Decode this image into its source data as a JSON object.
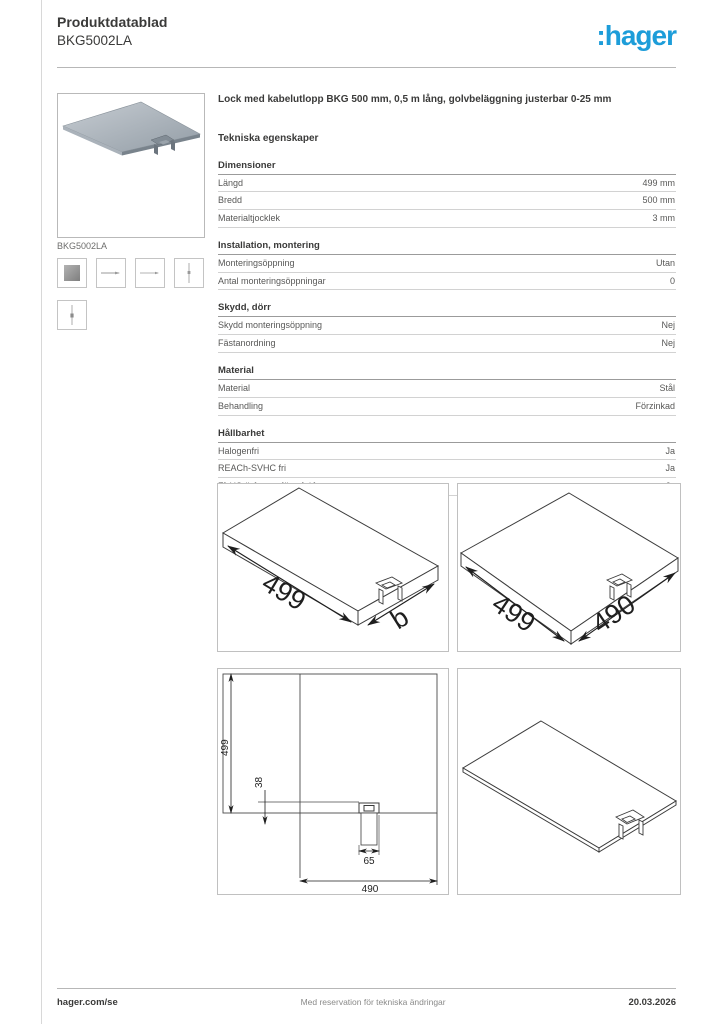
{
  "header": {
    "doc_type": "Produktdatablad",
    "product_id": "BKG5002LA",
    "brand_logo": ":hager",
    "brand_color": "#1d9dd9"
  },
  "product": {
    "image_caption": "BKG5002LA",
    "thumbnails": [
      "product-photo-thumb",
      "side-view-thumb",
      "side-view-thumb-2",
      "end-view-thumb",
      "end-view-thumb-2"
    ]
  },
  "description": "Lock med kabelutlopp BKG 500 mm,  0,5 m lång, golvbeläggning justerbar 0-25 mm",
  "specs": {
    "title": "Tekniska egenskaper",
    "groups": [
      {
        "name": "Dimensioner",
        "rows": [
          {
            "label": "Längd",
            "value": "499 mm"
          },
          {
            "label": "Bredd",
            "value": "500 mm"
          },
          {
            "label": "Materialtjocklek",
            "value": "3 mm"
          }
        ]
      },
      {
        "name": "Installation, montering",
        "rows": [
          {
            "label": "Monteringsöppning",
            "value": "Utan"
          },
          {
            "label": "Antal monteringsöppningar",
            "value": "0"
          }
        ]
      },
      {
        "name": "Skydd, dörr",
        "rows": [
          {
            "label": "Skydd monteringsöppning",
            "value": "Nej"
          },
          {
            "label": "Fästanordning",
            "value": "Nej"
          }
        ]
      },
      {
        "name": "Material",
        "rows": [
          {
            "label": "Material",
            "value": "Stål"
          },
          {
            "label": "Behandling",
            "value": "Förzinkad"
          }
        ]
      },
      {
        "name": "Hållbarhet",
        "rows": [
          {
            "label": "Halogenfri",
            "value": "Ja"
          },
          {
            "label": "REACh-SVHC fri",
            "value": "Ja"
          },
          {
            "label": "RoHS-överensstämmelse",
            "value": "Ja"
          }
        ]
      }
    ]
  },
  "illustrations": {
    "title": "Illustrationer | teckningar",
    "iso1": {
      "dim_long": "499",
      "dim_short": "b"
    },
    "iso2": {
      "dim_long": "499",
      "dim_short": "490"
    },
    "plan": {
      "dim_height": "499",
      "dim_offset": "38",
      "dim_outlet": "65",
      "dim_width": "490"
    }
  },
  "footer": {
    "website": "hager.com/se",
    "disclaimer": "Med reservation för tekniska ändringar",
    "date": "20.03.2026"
  }
}
